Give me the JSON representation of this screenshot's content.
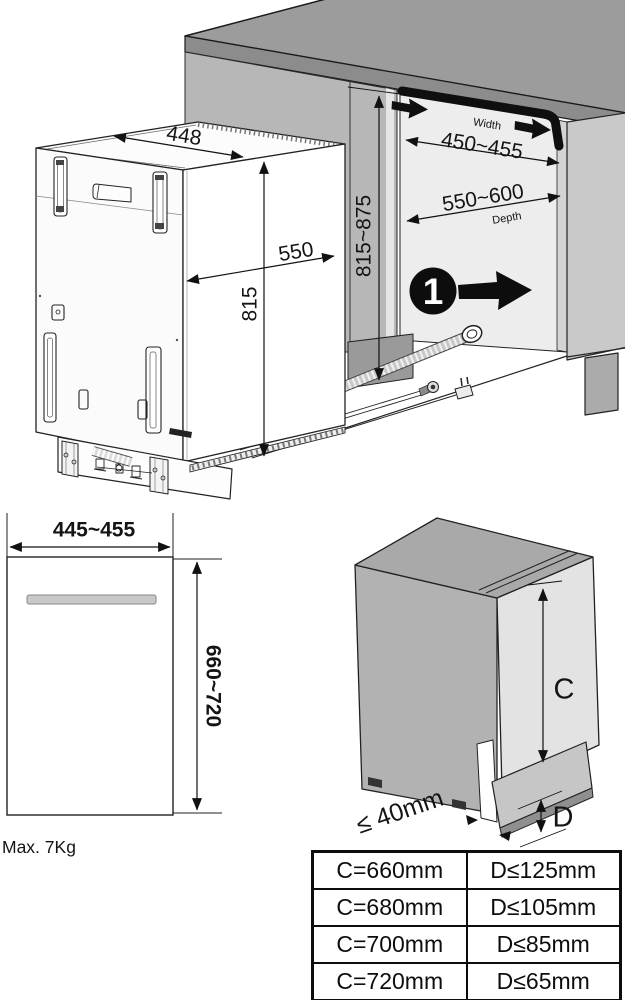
{
  "diagram": {
    "step_badge": "1",
    "dims": {
      "top_width": "448",
      "top_depth": "550",
      "unit_height": "815",
      "niche_height": "815~875",
      "niche_width_label": "Width",
      "niche_width": "450~455",
      "niche_depth": "550~600",
      "niche_depth_label": "Depth"
    },
    "front_view": {
      "width": "445~455",
      "height": "660~720",
      "max_weight": "Max. 7Kg"
    },
    "door_view": {
      "plinth_gap": "≤ 40mm",
      "c_label": "C",
      "d_label": "D"
    },
    "table": {
      "rows": [
        {
          "c": "C=660mm",
          "d": "D≤125mm"
        },
        {
          "c": "C=680mm",
          "d": "D≤105mm"
        },
        {
          "c": "C=700mm",
          "d": "D≤85mm"
        },
        {
          "c": "C=720mm",
          "d": "D≤65mm"
        }
      ]
    },
    "colors": {
      "line": "#1a1a1a",
      "counter_gray": "#9c9c9c",
      "accent_black": "#0d0d0d"
    }
  }
}
